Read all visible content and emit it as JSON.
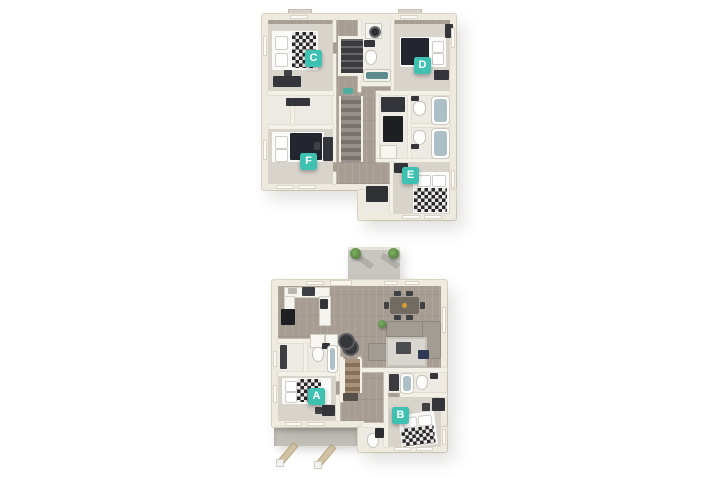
{
  "palette": {
    "background": "#ffffff",
    "marker_bg": "#3fc1b2",
    "marker_text": "#ffffff",
    "wall": "#eeeade",
    "wood_floor": "#a79d93",
    "carpet": "#d8d4cc",
    "tile": "#eceae3",
    "tub": "#aec0c7"
  },
  "floor_plans": [
    {
      "id": "upper-floor",
      "markers": [
        {
          "letter": "C"
        },
        {
          "letter": "D"
        },
        {
          "letter": "E"
        },
        {
          "letter": "F"
        }
      ]
    },
    {
      "id": "lower-floor",
      "markers": [
        {
          "letter": "A"
        },
        {
          "letter": "B"
        }
      ]
    }
  ]
}
